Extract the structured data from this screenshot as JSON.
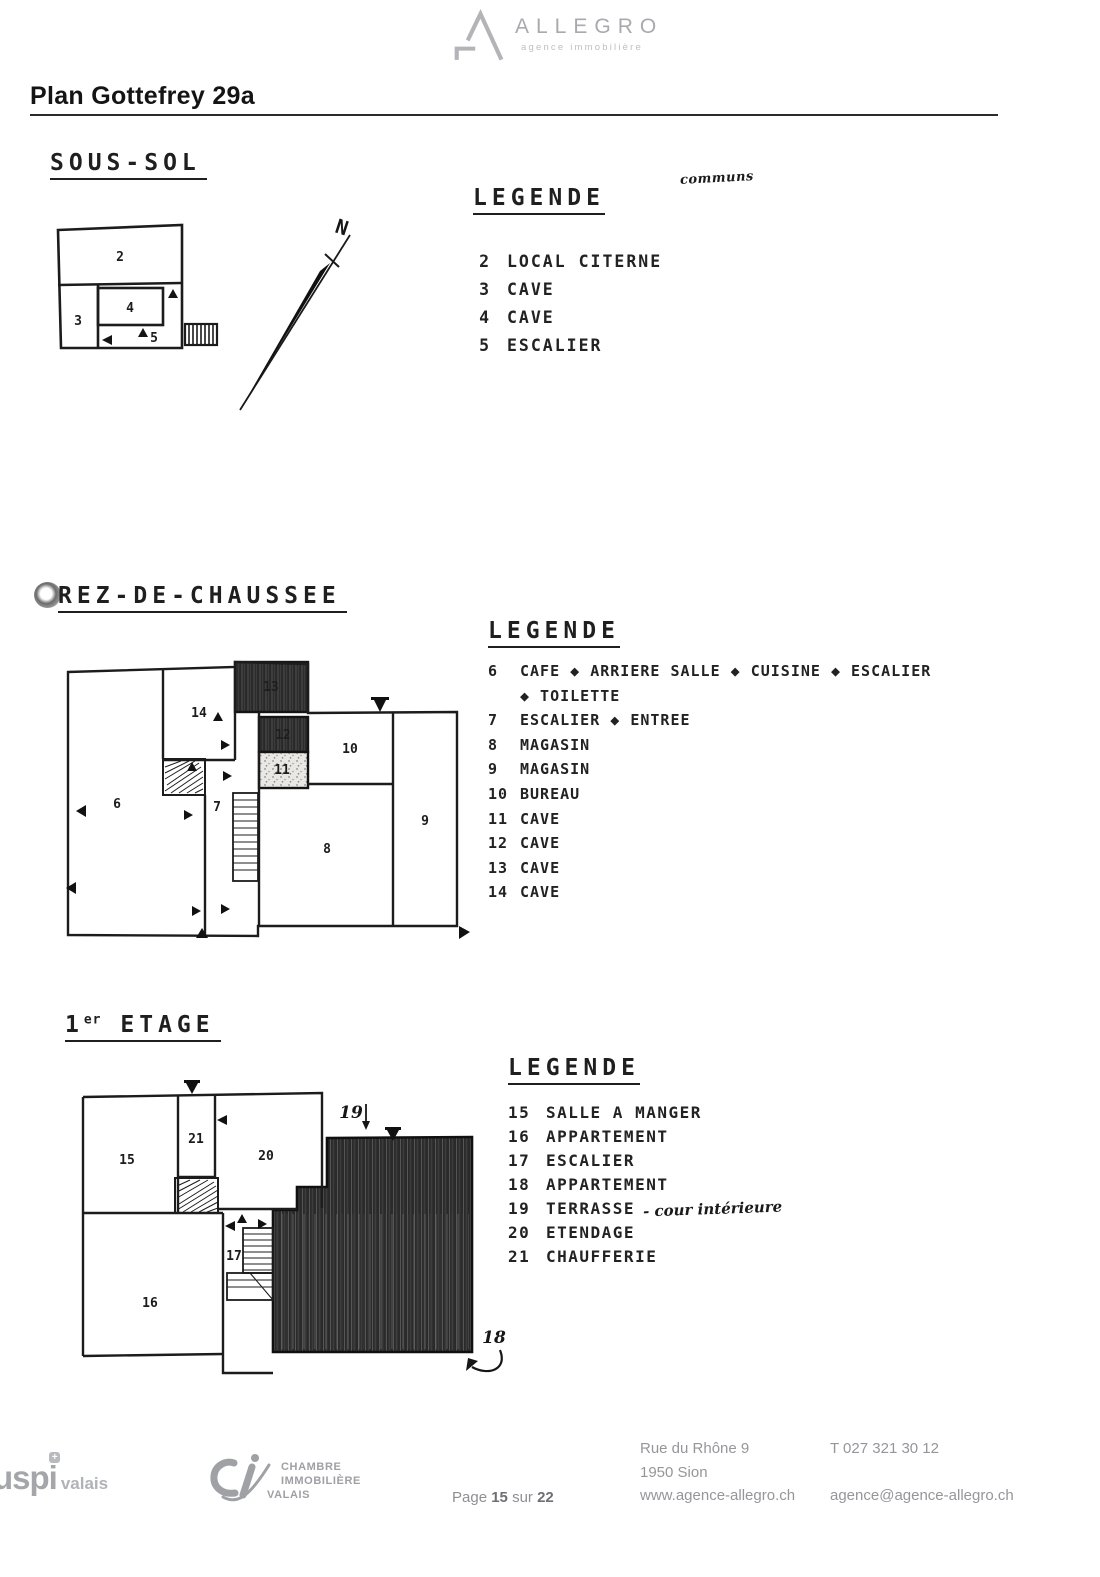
{
  "header": {
    "logo_text": "ALLEGRO",
    "logo_subtitle": "agence immobilière",
    "title": "Plan Gottefrey 29a"
  },
  "sous_sol": {
    "heading": "SOUS-SOL",
    "legend_title": "LEGENDE",
    "handwritten_note": "communs",
    "north_label": "N",
    "rooms": {
      "r2": "2",
      "r3": "3",
      "r4": "4",
      "r5": "5"
    },
    "legend": [
      {
        "num": "2",
        "label": "LOCAL CITERNE"
      },
      {
        "num": "3",
        "label": "CAVE"
      },
      {
        "num": "4",
        "label": "CAVE"
      },
      {
        "num": "5",
        "label": "ESCALIER"
      }
    ]
  },
  "rez": {
    "heading": "REZ-DE-CHAUSSEE",
    "legend_title": "LEGENDE",
    "rooms": {
      "r6": "6",
      "r7": "7",
      "r8": "8",
      "r9": "9",
      "r10": "10",
      "r11": "11",
      "r12": "12",
      "r13": "13",
      "r14": "14"
    },
    "legend": [
      {
        "num": "6",
        "label": "CAFE ◆ ARRIERE SALLE ◆ CUISINE ◆ ESCALIER"
      },
      {
        "num": "",
        "label": "◆ TOILETTE"
      },
      {
        "num": "7",
        "label": "ESCALIER ◆ ENTREE"
      },
      {
        "num": "8",
        "label": "MAGASIN"
      },
      {
        "num": "9",
        "label": "MAGASIN"
      },
      {
        "num": "10",
        "label": "BUREAU"
      },
      {
        "num": "11",
        "label": "CAVE"
      },
      {
        "num": "12",
        "label": "CAVE"
      },
      {
        "num": "13",
        "label": "CAVE"
      },
      {
        "num": "14",
        "label": "CAVE"
      }
    ]
  },
  "etage": {
    "heading_num": "1",
    "heading_sup": "er",
    "heading_rest": "ETAGE",
    "legend_title": "LEGENDE",
    "rooms": {
      "r15": "15",
      "r16": "16",
      "r17": "17",
      "r20": "20",
      "r21": "21"
    },
    "annotation_18": "18",
    "annotation_19": "19",
    "legend": [
      {
        "num": "15",
        "label": "SALLE A MANGER",
        "handwritten": ""
      },
      {
        "num": "16",
        "label": "APPARTEMENT",
        "handwritten": ""
      },
      {
        "num": "17",
        "label": "ESCALIER",
        "handwritten": ""
      },
      {
        "num": "18",
        "label": "APPARTEMENT",
        "handwritten": ""
      },
      {
        "num": "19",
        "label": "TERRASSE",
        "handwritten": "- cour intérieure"
      },
      {
        "num": "20",
        "label": "ETENDAGE",
        "handwritten": ""
      },
      {
        "num": "21",
        "label": "CHAUFFERIE",
        "handwritten": ""
      }
    ]
  },
  "footer": {
    "uspi_main": "uspi",
    "uspi_pin": "+",
    "uspi_region": "valais",
    "chambre_line1": "CHAMBRE",
    "chambre_line2": "IMMOBILIÈRE",
    "chambre_line3": "VALAIS",
    "page_prefix": "Page",
    "page_current": "15",
    "page_separator": "sur",
    "page_total": "22",
    "address_line1": "Rue du Rhône 9",
    "address_line2": "1950 Sion",
    "address_line3": "www.agence-allegro.ch",
    "phone": "T 027 321 30 12",
    "email": "agence@agence-allegro.ch"
  }
}
